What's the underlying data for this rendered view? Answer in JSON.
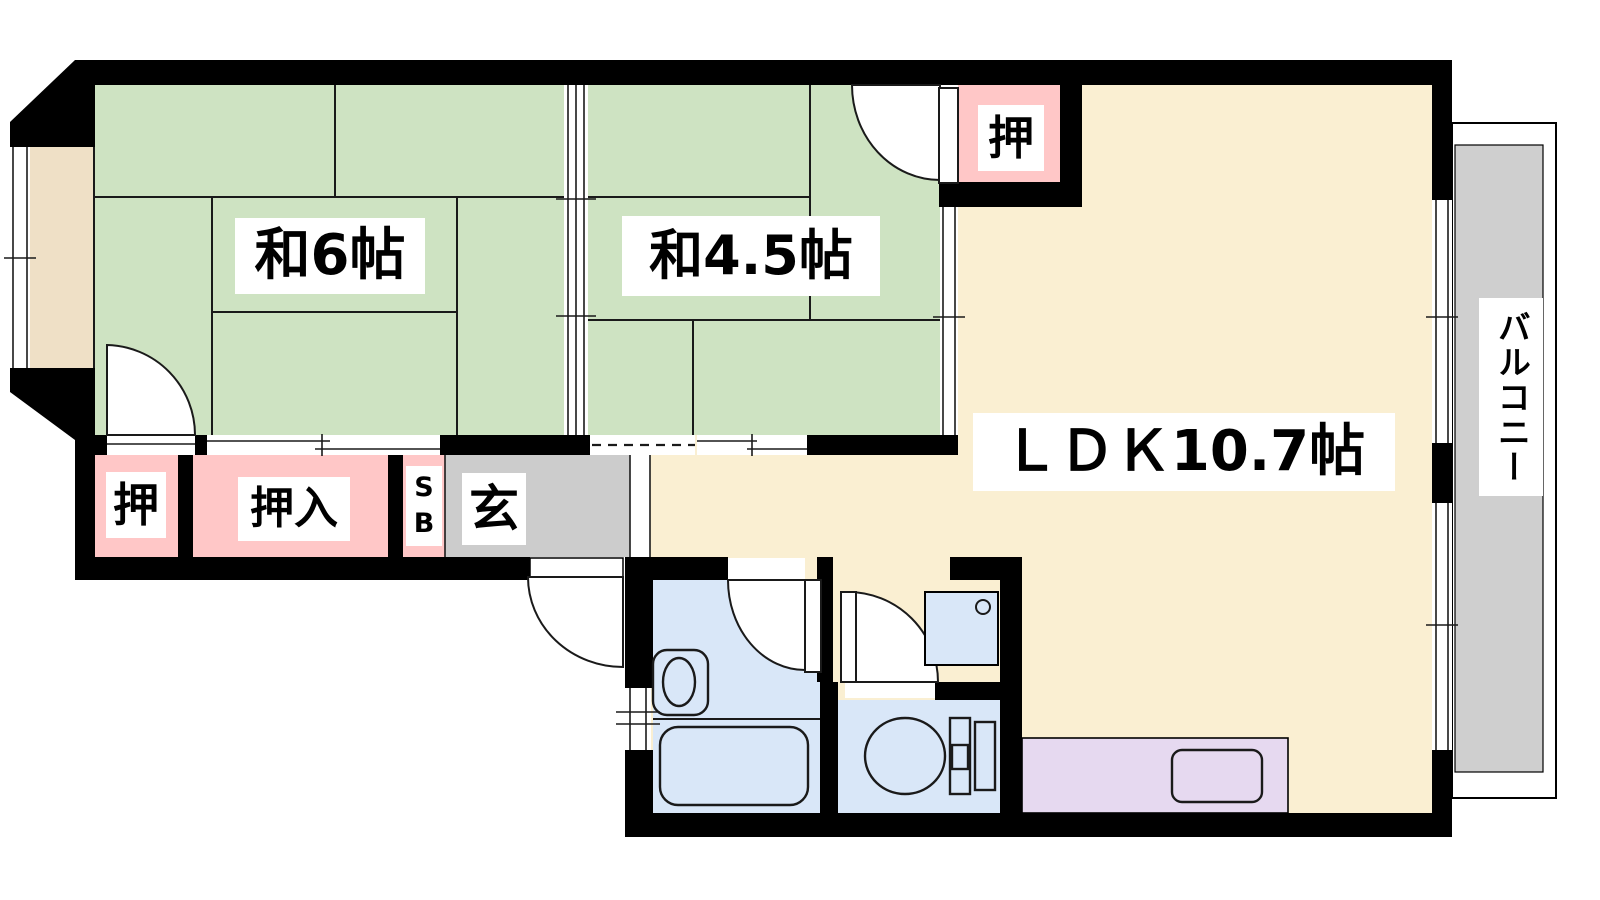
{
  "title": "floor-plan",
  "rooms": {
    "jp6": {
      "label": "和6帖",
      "type": "japanese-room",
      "size_jo": 6
    },
    "jp45": {
      "label": "和4.5帖",
      "type": "japanese-room",
      "size_jo": 4.5
    },
    "ldk": {
      "label": "ＬＤＫ10.7帖",
      "type": "living-dining-kitchen",
      "size_jo": 10.7
    },
    "closet_top": {
      "label": "押",
      "type": "closet"
    },
    "closet_bottom": {
      "label": "押",
      "type": "closet"
    },
    "oshiire": {
      "label": "押入",
      "type": "closet"
    },
    "shoebox": {
      "label": "S\nB",
      "type": "shoe-box"
    },
    "entrance": {
      "label": "玄",
      "type": "entrance"
    },
    "balcony": {
      "label": "バルコニー",
      "type": "balcony"
    }
  },
  "colors": {
    "wall": "#000000",
    "line": "#1a1a1a",
    "tatami": "#cee3c2",
    "ldk": "#faefd2",
    "closet": "#ffc7c7",
    "genkan": "#cccccc",
    "bay": "#efe0c6",
    "bath": "#d9e7f8",
    "balcony": "#cfcfcf",
    "kitchen": "#e6d9f0"
  }
}
